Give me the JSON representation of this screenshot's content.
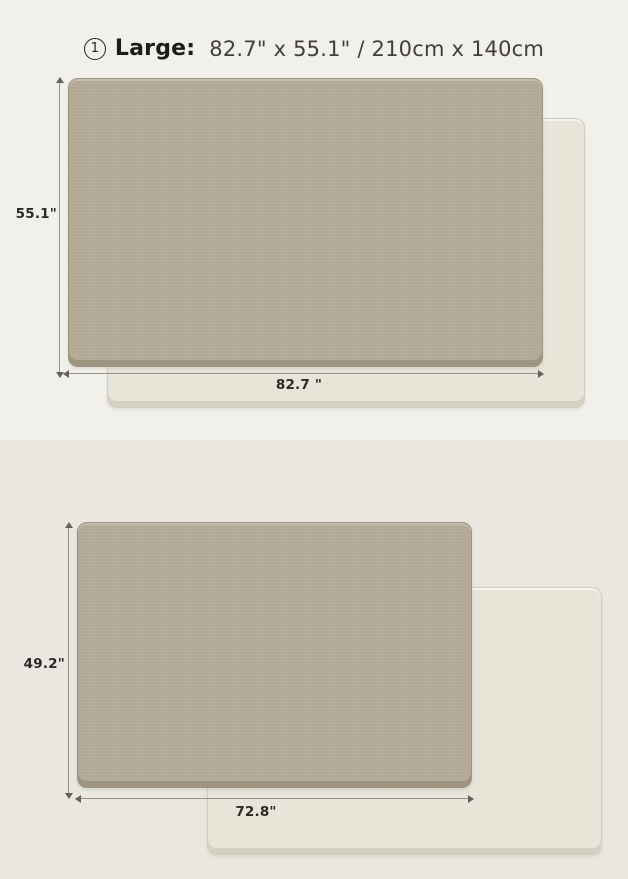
{
  "sections": [
    {
      "badge_number": "1",
      "size_name": "Large:",
      "size_spec": "82.7\" x 55.1\" / 210cm x 140cm",
      "height_label": "55.1\"",
      "width_label": "82.7 \""
    },
    {
      "badge_number": "2",
      "size_name": "Medium:",
      "size_spec": "72.8\" x 49.2\" / 185cm x 125cm",
      "height_label": "49.2\"",
      "width_label": "72.8\""
    }
  ],
  "colors": {
    "section1_background": "#f2f0ea",
    "section2_background": "#eae7e0",
    "mat_front_side": "#b4ab97",
    "mat_back_side": "#e8e5d9",
    "dimension_line": "#94928a",
    "title_text": "#1d1c17",
    "spec_text": "#413f38",
    "label_text": "#2b2a24"
  }
}
